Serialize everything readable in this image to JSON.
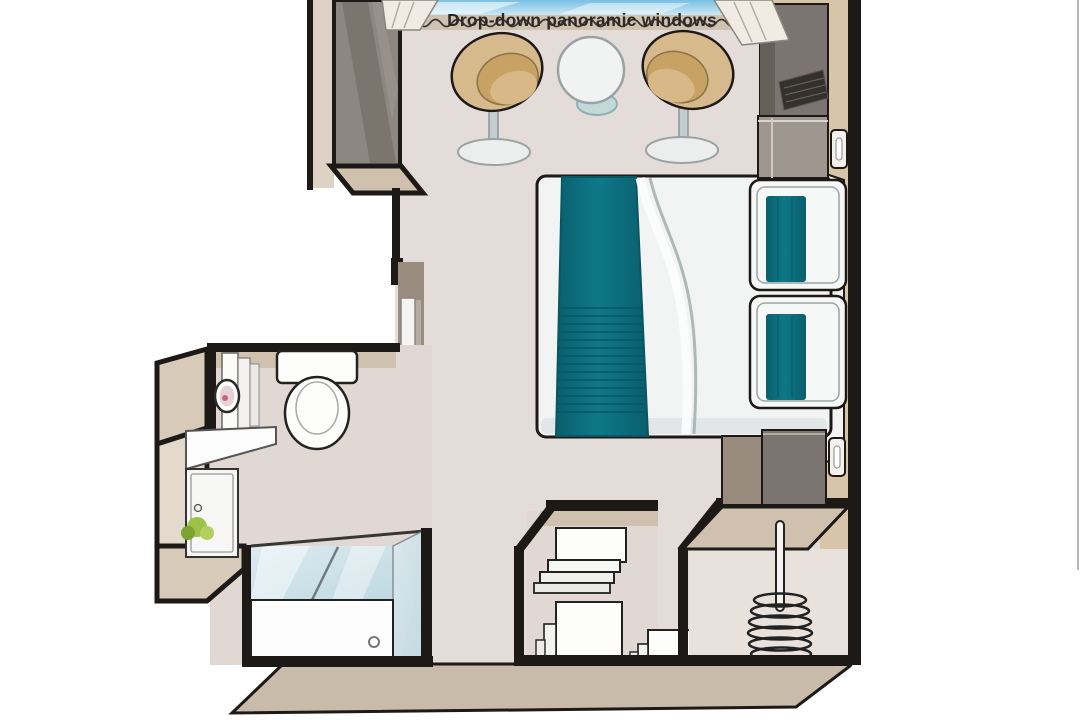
{
  "window_label": "Drop-down panoramic windows",
  "items": [
    "drop-down-panoramic-windows",
    "curtains",
    "armchair-left",
    "armchair-right",
    "round-table",
    "double-bed",
    "teal-bed-runner",
    "pillow-top",
    "pillow-bottom",
    "headboard",
    "tv-cabinet",
    "tv-screen",
    "media-unit",
    "wall-switch-top",
    "wall-switch-bottom",
    "nightstand",
    "bathroom",
    "toilet",
    "vanity-counter",
    "vanity-cabinet",
    "magnifying-mirror",
    "towel-shelves",
    "plant",
    "shower",
    "shower-glass",
    "shower-tray",
    "drain",
    "closet-shelf-unit",
    "storage-drawers",
    "wardrobe",
    "hanging-rod",
    "hangers",
    "sliding-door"
  ],
  "colors": {
    "white": "#ffffff",
    "wall_line": "#1c1917",
    "floor": "#e3dcd9",
    "bath_floor": "#e1d8d3",
    "wall_face": "#cfc1ae",
    "wall_right": "#d8c4a7",
    "wall_outer": "#d7cab8",
    "wall_outer_light": "#e4dacb",
    "slab": "#c8bbaa",
    "pillar": "#8d8781",
    "pillar_dark": "#6f6963",
    "pillar_light": "#a39c95",
    "outer_strip": "#ddd2c4",
    "niche": "#9a8c7e",
    "door_white": "#f5f4f2",
    "door_side": "#b3aca3",
    "unit_dark": "#7b7470",
    "unit_side": "#655f5a",
    "unit_mid": "#9f978f",
    "screen": "#34302c",
    "nightstand_side": "#988b7e",
    "teal": "#0e7888",
    "teal_dark": "#0a5f6d",
    "teal_deep": "#085763",
    "bed_white": "#f2f4f3",
    "bed_shadow": "#d9dfde",
    "crease": "#aeb8b7",
    "chair_tan": "#d6b98c",
    "chair_mid": "#c8a164",
    "chair_seat": "#d8b887",
    "base_gray": "#eceeed",
    "stem_gray": "#c3ccce",
    "win_top": "#79bfe3",
    "win_bottom": "#d7eef8",
    "sill": "#cfc2b1",
    "curtain": "#f0ece4",
    "glass_a": "#dcebf0",
    "glass_b": "#bfd9e2",
    "tub": "#fbfcfb",
    "plant_a": "#9cc24a",
    "plant_b": "#7aa32f",
    "plant_c": "#b1d05e",
    "label": "#2d2825",
    "edge": "#a8a8a8"
  }
}
